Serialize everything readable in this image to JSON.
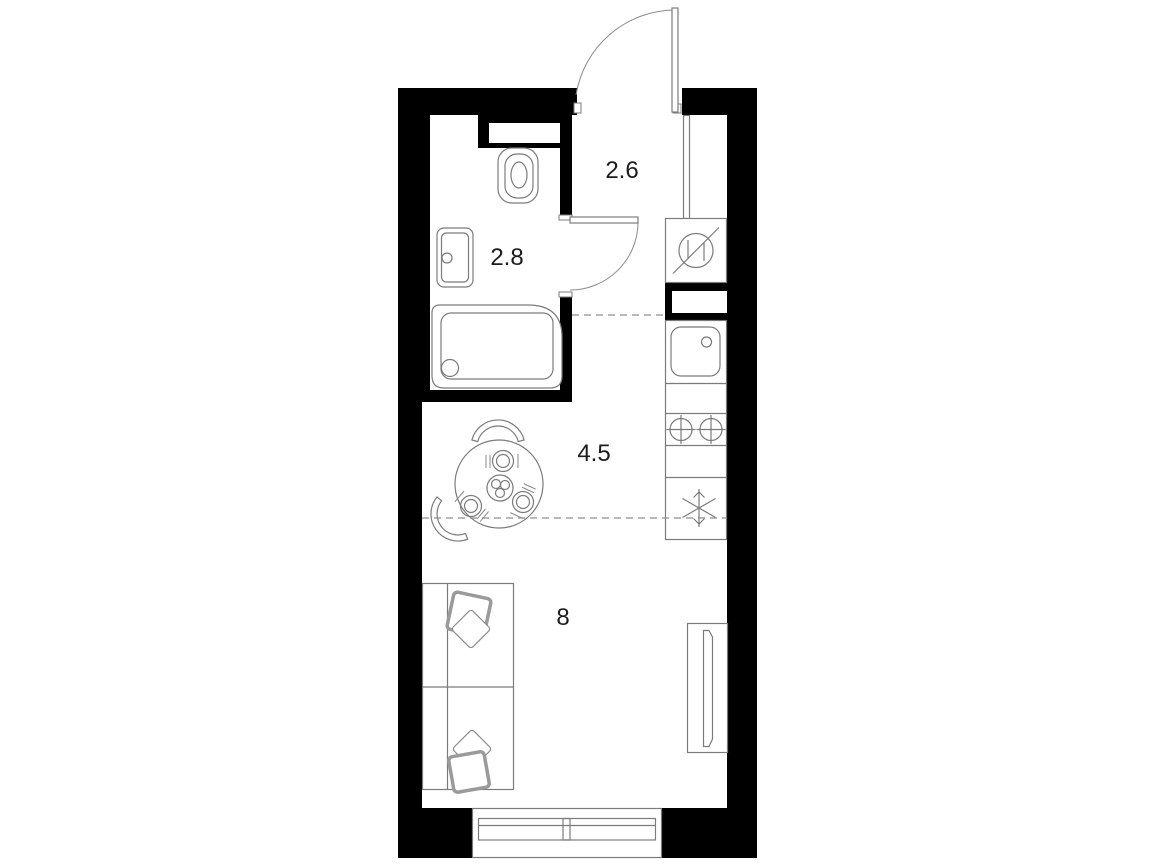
{
  "rooms": {
    "entry_hall": {
      "area_label": "2.6"
    },
    "bathroom": {
      "area_label": "2.8"
    },
    "kitchen": {
      "area_label": "4.5"
    },
    "living_room": {
      "area_label": "8"
    }
  },
  "fixtures": {
    "bathroom": [
      "toilet",
      "sink",
      "shower-tray",
      "installation-niche"
    ],
    "entry_hall": [
      "entrance-door",
      "washing-machine"
    ],
    "kitchen": [
      "kitchen-sink",
      "two-burner-stove",
      "refrigerator",
      "counter",
      "ventilation-shaft",
      "dining-table",
      "chairs"
    ],
    "living_room": [
      "sofa-bed",
      "pillows",
      "tv-console",
      "window"
    ]
  },
  "colors": {
    "walls": "#000000",
    "fixture_outline": "#7b7b7b",
    "dashed_divider": "#8f8f8f",
    "background": "#ffffff",
    "label_text": "#1c1c1c"
  }
}
